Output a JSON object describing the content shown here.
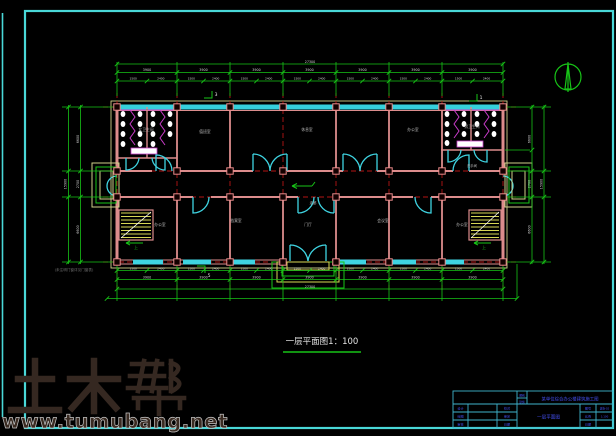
{
  "meta": {
    "drawing_title": "一层平面图1：100"
  },
  "watermark": {
    "logo": "土木帮",
    "url": "www.tumubang.net"
  },
  "north_arrow": "north-indicator",
  "plan": {
    "room_labels": [
      {
        "text": "女卫生间",
        "x": 146,
        "y": 131,
        "s": 3.8
      },
      {
        "text": "值班室",
        "x": 205,
        "y": 133,
        "s": 3.8
      },
      {
        "text": "休息室",
        "x": 307,
        "y": 131,
        "s": 3.8
      },
      {
        "text": "办公室",
        "x": 413,
        "y": 131,
        "s": 3.8
      },
      {
        "text": "男卫生间",
        "x": 472,
        "y": 128,
        "s": 3.8
      },
      {
        "text": "洗手间",
        "x": 472,
        "y": 167,
        "s": 3.4
      },
      {
        "text": "办公室",
        "x": 160,
        "y": 226,
        "s": 3.8
      },
      {
        "text": "档案室",
        "x": 236,
        "y": 222,
        "s": 3.8
      },
      {
        "text": "门厅",
        "x": 308,
        "y": 226,
        "s": 3.8
      },
      {
        "text": "会议室",
        "x": 383,
        "y": 222,
        "s": 3.8
      },
      {
        "text": "办公室",
        "x": 462,
        "y": 226,
        "s": 3.8
      },
      {
        "text": "走廊",
        "x": 313,
        "y": 204,
        "s": 3.4
      },
      {
        "text": "上",
        "x": 136,
        "y": 249,
        "s": 4,
        "c": "#17c417"
      },
      {
        "text": "上",
        "x": 484,
        "y": 249,
        "s": 4,
        "c": "#17c417"
      },
      {
        "text": "(未注明门窗详见门窗表)",
        "x": 74,
        "y": 271,
        "s": 3.6,
        "c": "#6f6f6f"
      }
    ],
    "section_markers": [
      {
        "text": "3",
        "x": 216,
        "y": 96
      },
      {
        "text": "1",
        "x": 481,
        "y": 99
      },
      {
        "text": "5",
        "x": 209,
        "y": 277
      }
    ]
  },
  "dimensions": {
    "top": {
      "overall": "27300",
      "bays": [
        "3900",
        "3900",
        "3900",
        "3900",
        "3900",
        "3900",
        "3900"
      ],
      "subs": [
        "1500",
        "2400",
        "1500",
        "2400",
        "1500",
        "2400",
        "1500",
        "2400",
        "1500",
        "2400",
        "1500",
        "2400",
        "1500",
        "2400"
      ]
    },
    "bottom": {
      "overall": "27300",
      "bays": [
        "3900",
        "3900",
        "3900",
        "3900",
        "3900",
        "3900",
        "3900"
      ],
      "subs": [
        "1500",
        "2400",
        "1500",
        "2400",
        "1500",
        "2400",
        "1500",
        "2400",
        "1500",
        "2400",
        "1500",
        "2400",
        "1500",
        "2400"
      ]
    },
    "left": {
      "overall": "15900",
      "bays": [
        "6600",
        "2700",
        "6600"
      ]
    },
    "right": {
      "overall": "15900",
      "bays": [
        "6600",
        "2700",
        "6600"
      ]
    }
  },
  "title_block": {
    "stage_label": "图别",
    "stage": "建施",
    "project": "某单位综合办公楼建筑施工图",
    "drawing_name": "一层平面图",
    "rows_left": [
      [
        "设计",
        "校对"
      ],
      [
        "绘图",
        "审定"
      ],
      [
        "审核",
        "日期"
      ]
    ],
    "rows_right": [
      [
        "图号",
        "建施-02"
      ],
      [
        "比例",
        "1:100"
      ],
      [
        "日期",
        ""
      ]
    ]
  },
  "colors": {
    "background": "#000000",
    "frame": "#49d8d8",
    "dims": "#17c417",
    "axes": "#b41414",
    "walls": "#dc8c8c",
    "windows": "#3fd4e2",
    "fixtures": "#c83cc8",
    "stairs": "#d8d855",
    "roof": "#d0d08a",
    "titleblock_text": "#4450f0",
    "watermark": "#352821"
  }
}
